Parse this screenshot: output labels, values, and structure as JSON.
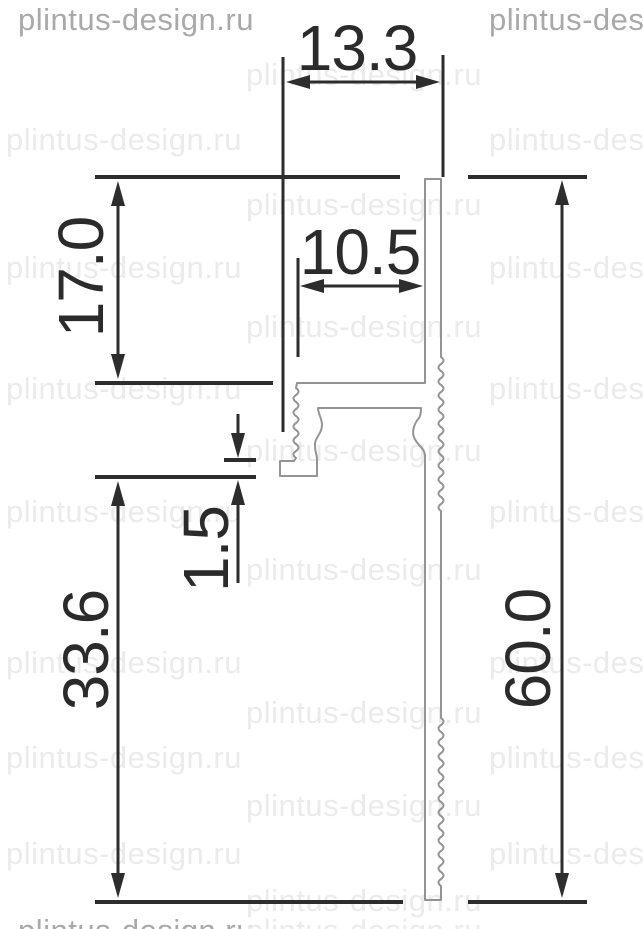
{
  "title": "Aluminium plinth profile cross-section drawing",
  "watermark": {
    "text": "plintus-design.ru"
  },
  "dimensions": {
    "top_width": "13.3",
    "inner_width": "10.5",
    "upper_height": "17.0",
    "lip_thickness": "1.5",
    "lower_height": "33.6",
    "total_height": "60.0"
  },
  "colors": {
    "dimension_lines": "#2d2d2d",
    "dimension_text": "#2b2b2b",
    "profile_outline": "#949494",
    "watermark_light": "#ebebeb",
    "watermark_dark": "#a9a9a9",
    "background": "#ffffff"
  },
  "watermark_instances": [
    {
      "x": 18,
      "y": 2,
      "dark": true
    },
    {
      "x": 489,
      "y": 2,
      "dark": true
    },
    {
      "x": 246,
      "y": 57,
      "dark": false
    },
    {
      "x": 6,
      "y": 122,
      "dark": false
    },
    {
      "x": 489,
      "y": 122,
      "dark": false
    },
    {
      "x": 246,
      "y": 187,
      "dark": false
    },
    {
      "x": 6,
      "y": 250,
      "dark": false
    },
    {
      "x": 489,
      "y": 250,
      "dark": false
    },
    {
      "x": 246,
      "y": 309,
      "dark": false
    },
    {
      "x": 6,
      "y": 371,
      "dark": false
    },
    {
      "x": 489,
      "y": 371,
      "dark": false
    },
    {
      "x": 246,
      "y": 433,
      "dark": false
    },
    {
      "x": 6,
      "y": 494,
      "dark": false
    },
    {
      "x": 489,
      "y": 494,
      "dark": false
    },
    {
      "x": 246,
      "y": 552,
      "dark": false
    },
    {
      "x": 6,
      "y": 645,
      "dark": false
    },
    {
      "x": 489,
      "y": 645,
      "dark": false
    },
    {
      "x": 246,
      "y": 695,
      "dark": false
    },
    {
      "x": 6,
      "y": 740,
      "dark": false
    },
    {
      "x": 489,
      "y": 740,
      "dark": false
    },
    {
      "x": 246,
      "y": 788,
      "dark": false
    },
    {
      "x": 6,
      "y": 836,
      "dark": false
    },
    {
      "x": 489,
      "y": 836,
      "dark": false
    },
    {
      "x": 246,
      "y": 883,
      "dark": false
    },
    {
      "x": 18,
      "y": 913,
      "dark": true
    },
    {
      "x": 246,
      "y": 913,
      "dark": false
    }
  ]
}
